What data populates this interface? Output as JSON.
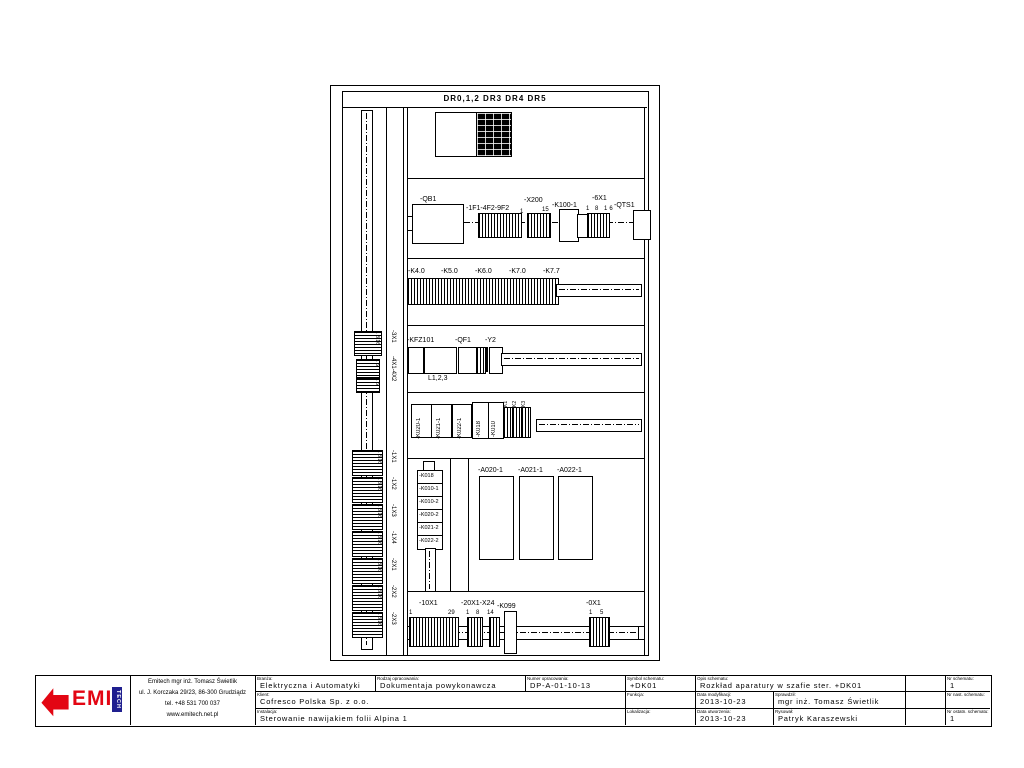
{
  "cabinet": {
    "header": "DR0,1,2 DR3 DR4 DR5",
    "left_rail": {
      "upper_nums": [
        "1 8 16",
        "1 6",
        "1 6"
      ],
      "upper_labels": [
        "-3X1",
        "-4X1-4X2"
      ],
      "block_nums": "1 8 16",
      "lower_labels": [
        "-1X1",
        "-1X2",
        "-1X3",
        "-1X4",
        "-2X1",
        "-2X2",
        "-2X3"
      ]
    },
    "row2": {
      "qb1": "-QB1",
      "fuses": "-1F1-4F2-9F2",
      "n1": "1",
      "n15": "15",
      "x200": "-X200",
      "k100": "-K100-1",
      "x6": "-6X1",
      "seq": "1 8 16",
      "qts1": "-QTS1"
    },
    "row3": {
      "labels": [
        "-K4.0",
        "-K5.0",
        "-K6.0",
        "-K7.0",
        "-K7.7"
      ]
    },
    "row4": {
      "labels": [
        "-KFZ101",
        "-QF1",
        "-Y2"
      ],
      "sub": "L1,2,3"
    },
    "row5": {
      "vlabels": [
        "-K020-1",
        "-K021-1",
        "-K022-1",
        "-K018",
        "-K010"
      ],
      "small": [
        "K1",
        "K2",
        "K3"
      ]
    },
    "row6": {
      "stack": [
        "-K018",
        "-K010-1",
        "-K010-2",
        "-K020-2",
        "-K021-2",
        "-K022-2"
      ],
      "drives": [
        "-A020-1",
        "-A021-1",
        "-A022-1"
      ]
    },
    "row7": {
      "labels": [
        "-10X1",
        "-20X1-X24",
        "-K099",
        "-0X1"
      ],
      "nums": [
        "1",
        "29",
        "1",
        "8",
        "14",
        "1",
        "5"
      ]
    }
  },
  "titleblock": {
    "logo": {
      "emi": "EMI",
      "tech": "TECH"
    },
    "company": {
      "lines": [
        "Emitech mgr inż. Tomasz Świetlik",
        "ul. J. Korczaka 29/23, 86-300 Grudziądz",
        "tel. +48 531 700 037",
        "www.emitech.net.pl"
      ]
    },
    "fields": {
      "branza": {
        "label": "Branża:",
        "value": "Elektryczna i Automatyki"
      },
      "rodzaj": {
        "label": "Rodzaj opracowania:",
        "value": "Dokumentaja powykonawcza"
      },
      "numer": {
        "label": "Numer opracowania:",
        "value": "DP-A-01-10-13"
      },
      "symbol": {
        "label": "Symbol schematu:",
        "value": "+DK01"
      },
      "opis": {
        "label": "Opis schematu:",
        "value": "Rozkład aparatury w szafie ster. +DK01"
      },
      "nr1": {
        "label": "Nr schematu:",
        "value": "1"
      },
      "klient": {
        "label": "Klient:",
        "value": "Cofresco Polska Sp. z o.o."
      },
      "funkcja": {
        "label": "Funkcja:",
        "value": ""
      },
      "data_mod": {
        "label": "Data modyfikacji:",
        "value": "2013-10-23"
      },
      "sprawdzil": {
        "label": "Sprawdził:",
        "value": "mgr inż. Tomasz Świetlik"
      },
      "nr2": {
        "label": "Nr nast. schematu:",
        "value": ""
      },
      "instalacja": {
        "label": "Instalacja:",
        "value": "Sterowanie nawijakiem folii Alpina 1"
      },
      "lokalizacja": {
        "label": "Lokalizacja:",
        "value": ""
      },
      "data_utw": {
        "label": "Data utworzenia:",
        "value": "2013-10-23"
      },
      "rysowal": {
        "label": "Rysował:",
        "value": "Patryk Karaszewski"
      },
      "nr3": {
        "label": "Nr ostatn. schematu:",
        "value": "1"
      }
    }
  }
}
